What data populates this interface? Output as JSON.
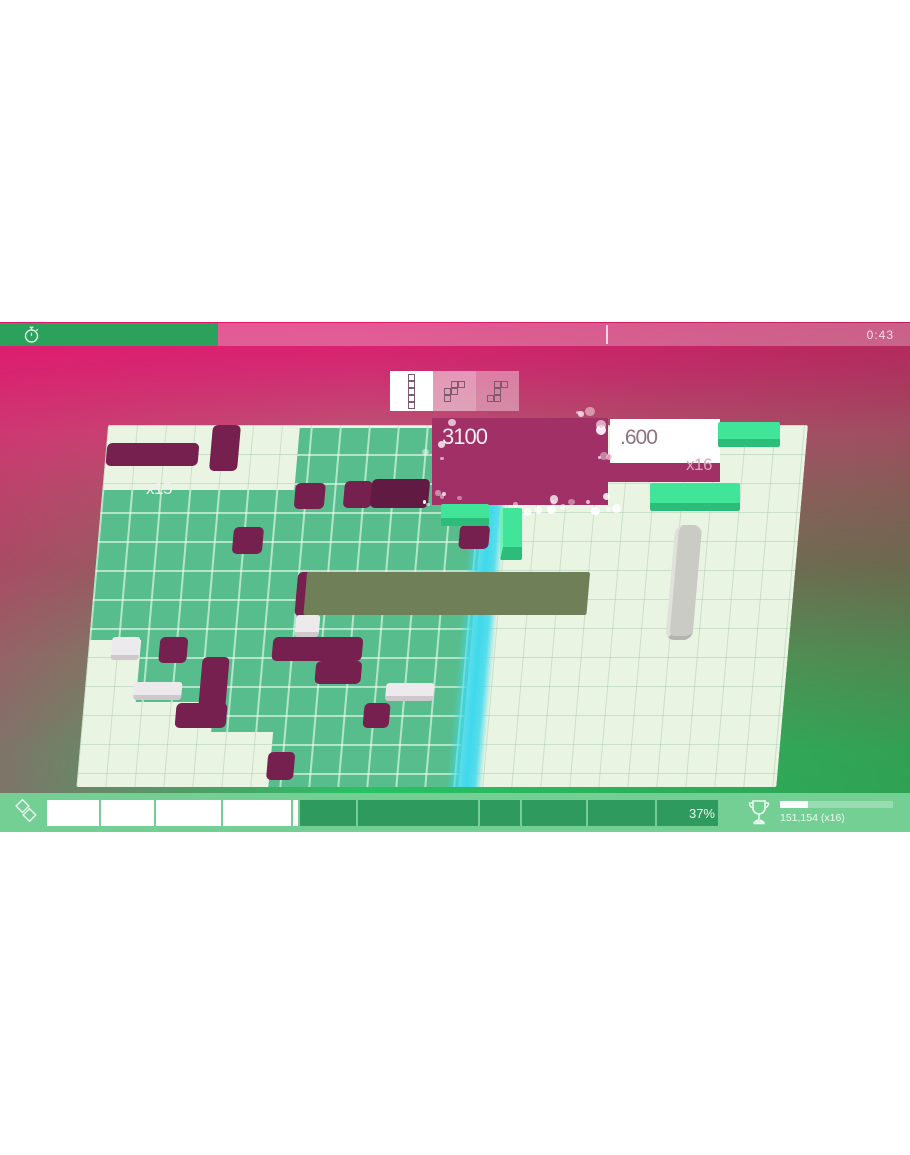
{
  "top_bar": {
    "time": "0:43"
  },
  "score_popups": {
    "magenta_score": "3100",
    "magenta_multiplier": "x15",
    "white_score": ".600",
    "white_multiplier": "x16"
  },
  "hud": {
    "clear_percent": "37%",
    "trophy_score": "151,154 (x16)"
  },
  "colors": {
    "magenta_bg": "#e2186e",
    "olive_bg": "#6f7455",
    "green_bg": "#27c163",
    "timer_green": "#2ba15c",
    "board_pale": "#eaf4e3",
    "board_green": "#58bd8c",
    "block_maroon": "#75204f",
    "block_white": "#eceaec",
    "block_olive": "#6f7f58",
    "block_grey": "#c9cbc4",
    "block_mint": "#40e59a",
    "cyan_strip": "#3ed9ec",
    "popup_magenta": "#a03066",
    "hud_bar_bg": "#73cf94",
    "hud_segment_dark": "#2f9a5d"
  },
  "preview": {
    "pieces": [
      {
        "name": "i5-vertical",
        "cells": [
          [
            0,
            0
          ],
          [
            0,
            1
          ],
          [
            0,
            2
          ],
          [
            0,
            3
          ],
          [
            0,
            4
          ]
        ]
      },
      {
        "name": "s-pentomino",
        "cells": [
          [
            1,
            0
          ],
          [
            2,
            0
          ],
          [
            1,
            1
          ],
          [
            0,
            1
          ],
          [
            0,
            2
          ]
        ]
      },
      {
        "name": "z-pentomino",
        "cells": [
          [
            1,
            0
          ],
          [
            2,
            0
          ],
          [
            1,
            1
          ],
          [
            1,
            2
          ],
          [
            0,
            2
          ]
        ]
      }
    ]
  },
  "board": {
    "green_zones": [
      [
        192,
        3,
        190,
        62
      ],
      [
        0,
        65,
        382,
        150
      ],
      [
        52,
        215,
        330,
        62
      ],
      [
        130,
        277,
        252,
        30
      ],
      [
        192,
        307,
        190,
        55
      ]
    ],
    "cyan_strip": [
      370,
      0,
      36,
      362
    ],
    "blocks": [
      {
        "t": "maroon",
        "r": [
          1,
          18,
          92,
          23
        ]
      },
      {
        "t": "maroon",
        "r": [
          105,
          0,
          28,
          46
        ]
      },
      {
        "t": "maroon",
        "r": [
          135,
          102,
          30,
          27
        ]
      },
      {
        "t": "maroon",
        "r": [
          193,
          58,
          30,
          26
        ]
      },
      {
        "t": "maroon",
        "r": [
          242,
          56,
          28,
          27
        ]
      },
      {
        "t": "maroon-dark",
        "r": [
          269,
          54,
          58,
          29
        ]
      },
      {
        "t": "maroon",
        "r": [
          361,
          100,
          30,
          24
        ]
      },
      {
        "t": "maroon",
        "r": [
          203,
          147,
          26,
          44
        ]
      },
      {
        "t": "maroon",
        "r": [
          71,
          212,
          28,
          26
        ]
      },
      {
        "t": "maroon",
        "r": [
          184,
          212,
          90,
          24
        ]
      },
      {
        "t": "maroon",
        "r": [
          229,
          236,
          46,
          23
        ]
      },
      {
        "t": "maroon",
        "r": [
          115,
          232,
          27,
          71
        ]
      },
      {
        "t": "maroon",
        "r": [
          93,
          278,
          51,
          25
        ]
      },
      {
        "t": "maroon",
        "r": [
          281,
          278,
          26,
          25
        ]
      },
      {
        "t": "maroon",
        "r": [
          189,
          327,
          27,
          28
        ]
      },
      {
        "t": "white",
        "r": [
          23,
          212,
          28,
          23
        ]
      },
      {
        "t": "white",
        "r": [
          49,
          257,
          48,
          18
        ]
      },
      {
        "t": "white",
        "r": [
          301,
          258,
          48,
          18
        ]
      },
      {
        "t": "white",
        "r": [
          205,
          190,
          24,
          22
        ]
      },
      {
        "t": "olive",
        "r": [
          212,
          147,
          283,
          43
        ]
      },
      {
        "t": "capsule",
        "r": [
          576,
          100,
          27,
          115
        ]
      }
    ],
    "overlay_blocks": [
      {
        "t": "mint",
        "r": [
          718,
          100,
          62,
          25
        ]
      },
      {
        "t": "mint",
        "r": [
          650,
          161,
          90,
          28
        ]
      },
      {
        "t": "mint-v",
        "r": [
          500,
          186,
          22,
          52
        ]
      },
      {
        "t": "mint",
        "r": [
          441,
          182,
          48,
          22
        ]
      }
    ]
  },
  "progress_segments": [
    {
      "x": 47,
      "w": 52,
      "f": "white"
    },
    {
      "x": 101,
      "w": 53,
      "f": "white"
    },
    {
      "x": 156,
      "w": 65,
      "f": "white"
    },
    {
      "x": 223,
      "w": 68,
      "f": "white"
    },
    {
      "x": 293,
      "w": 5,
      "f": "white"
    },
    {
      "x": 300,
      "w": 56,
      "f": "dark"
    },
    {
      "x": 358,
      "w": 120,
      "f": "dark"
    },
    {
      "x": 480,
      "w": 40,
      "f": "dark"
    },
    {
      "x": 522,
      "w": 64,
      "f": "dark"
    },
    {
      "x": 588,
      "w": 67,
      "f": "dark"
    },
    {
      "x": 657,
      "w": 61,
      "f": "dark"
    }
  ]
}
